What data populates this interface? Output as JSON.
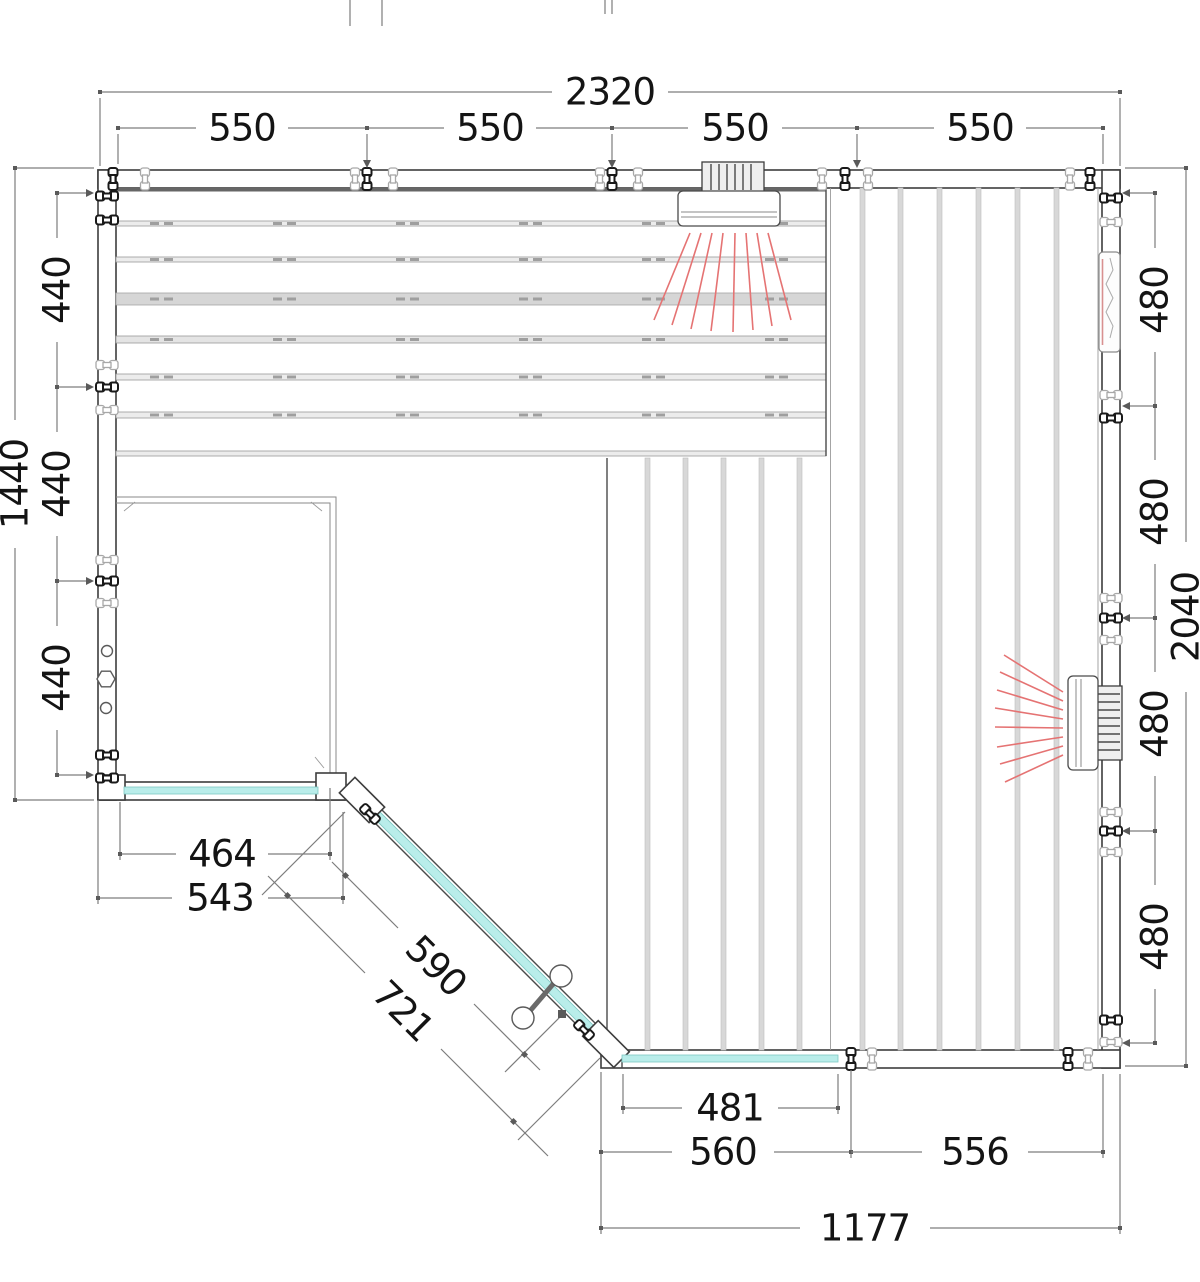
{
  "diagram": {
    "dimensions": {
      "top_total": "2320",
      "top_segments": [
        "550",
        "550",
        "550",
        "550"
      ],
      "left_total": "1440",
      "left_segments": [
        "440",
        "440",
        "440"
      ],
      "right_total": "2040",
      "right_segments": [
        "480",
        "480",
        "480",
        "480"
      ],
      "glass_front_left": [
        "464",
        "543"
      ],
      "door_diagonal": [
        "590",
        "721"
      ],
      "bottom": [
        "481",
        "560",
        "556",
        "1177"
      ]
    },
    "colors": {
      "glass": "#b9edea",
      "heater_rays": "#e57373",
      "dim_lines": "#7d7d7d",
      "text": "#141414"
    }
  }
}
